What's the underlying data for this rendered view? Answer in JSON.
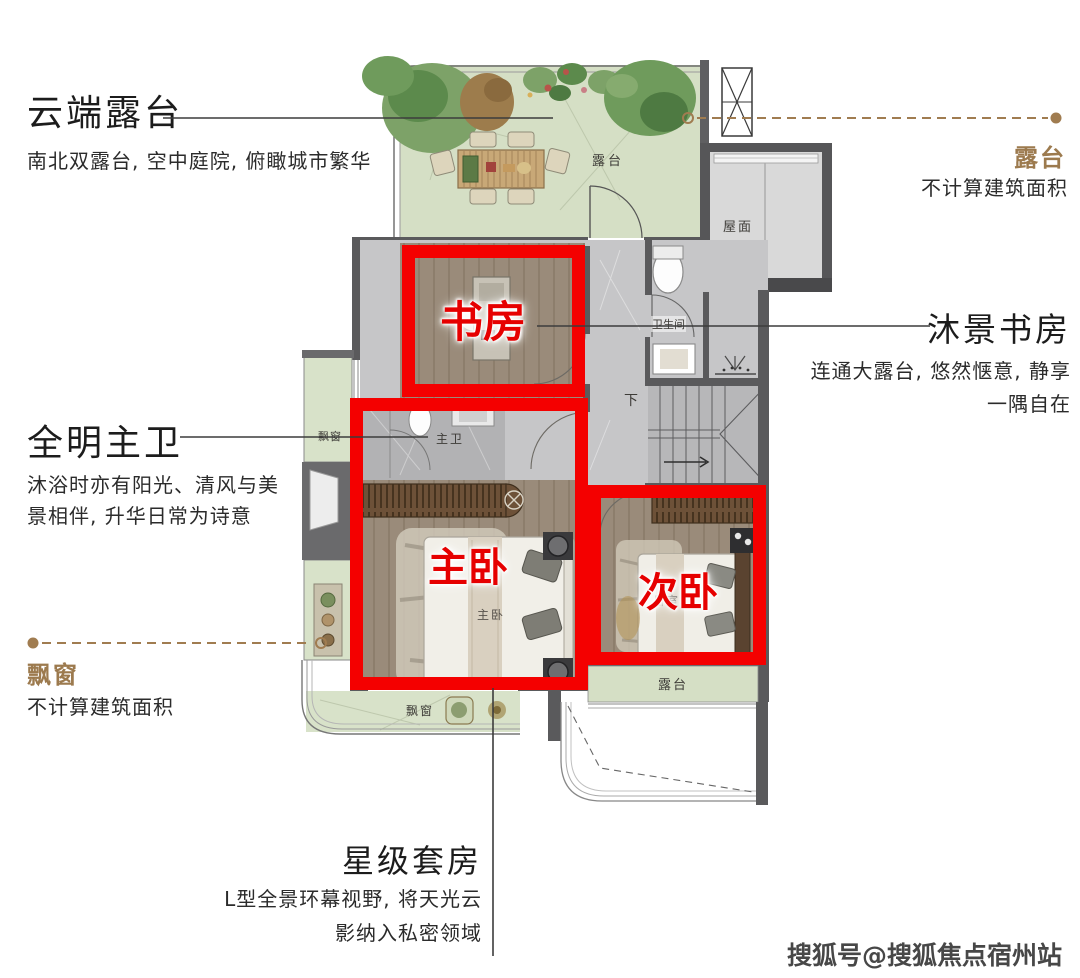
{
  "annotations": {
    "cloud_terrace": {
      "title": "云端露台",
      "subtitle": "南北双露台, 空中庭院, 俯瞰城市繁华"
    },
    "terrace_right": {
      "title": "露台",
      "subtitle": "不计算建筑面积"
    },
    "study": {
      "title": "沐景书房",
      "subtitle_line1": "连通大露台, 悠然惬意, 静享",
      "subtitle_line2": "一隅自在"
    },
    "master_bath": {
      "title": "全明主卫",
      "subtitle_line1": "沐浴时亦有阳光、清风与美",
      "subtitle_line2": "景相伴, 升华日常为诗意"
    },
    "bay_window": {
      "title": "飘窗",
      "subtitle": "不计算建筑面积"
    },
    "suite": {
      "title": "星级套房",
      "subtitle_line1": "L型全景环幕视野, 将天光云",
      "subtitle_line2": "影纳入私密领域"
    }
  },
  "plan": {
    "boxes": {
      "study": "书房",
      "master": "主卧",
      "second": "次卧"
    },
    "labels": {
      "terrace_top": "露台",
      "roof": "屋面",
      "bathroom": "卫生间",
      "down": "下",
      "master_bath": "主卫",
      "bay_left": "飘窗",
      "bay_bottom": "飘窗",
      "master_bed": "主卧",
      "second_bed": "卧室",
      "terrace_lower": "露台"
    }
  },
  "watermark": {
    "text": "搜狐号@搜狐焦点宿州站"
  },
  "colors": {
    "accent_brown": "#9c7a4e",
    "highlight_red": "#f40000"
  }
}
